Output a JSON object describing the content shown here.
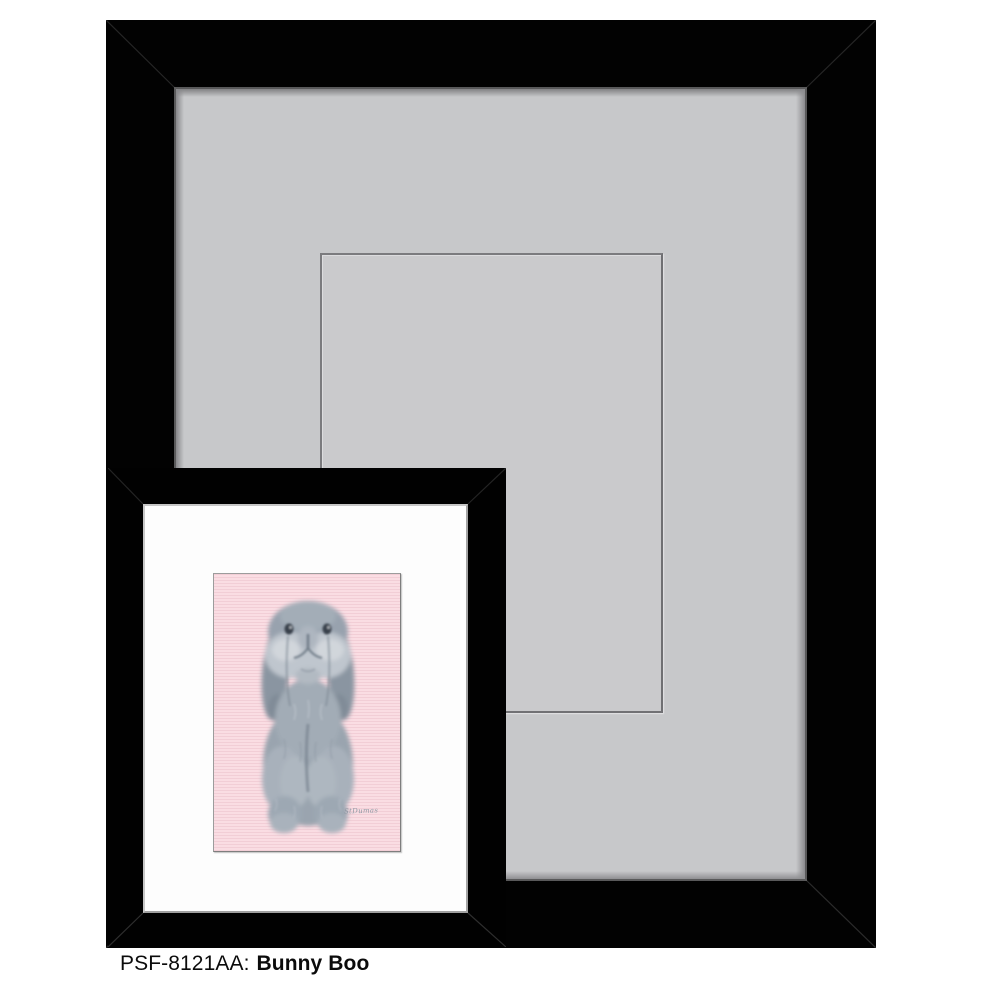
{
  "caption": {
    "sku": "PSF-8121AA:",
    "title": "Bunny Boo"
  },
  "artwork": {
    "subject": "gray-lop-bunny-painting",
    "signature": "StDumas",
    "background_color": "#fadde3"
  },
  "colors": {
    "large_frame": "#020202",
    "large_mat": "#c7c8ca",
    "mat_opening_line": "#737376",
    "small_frame": "#010101",
    "small_mat": "#fdfdfd",
    "bunny_gray": "#9aa4af",
    "page_background": "#ffffff"
  }
}
